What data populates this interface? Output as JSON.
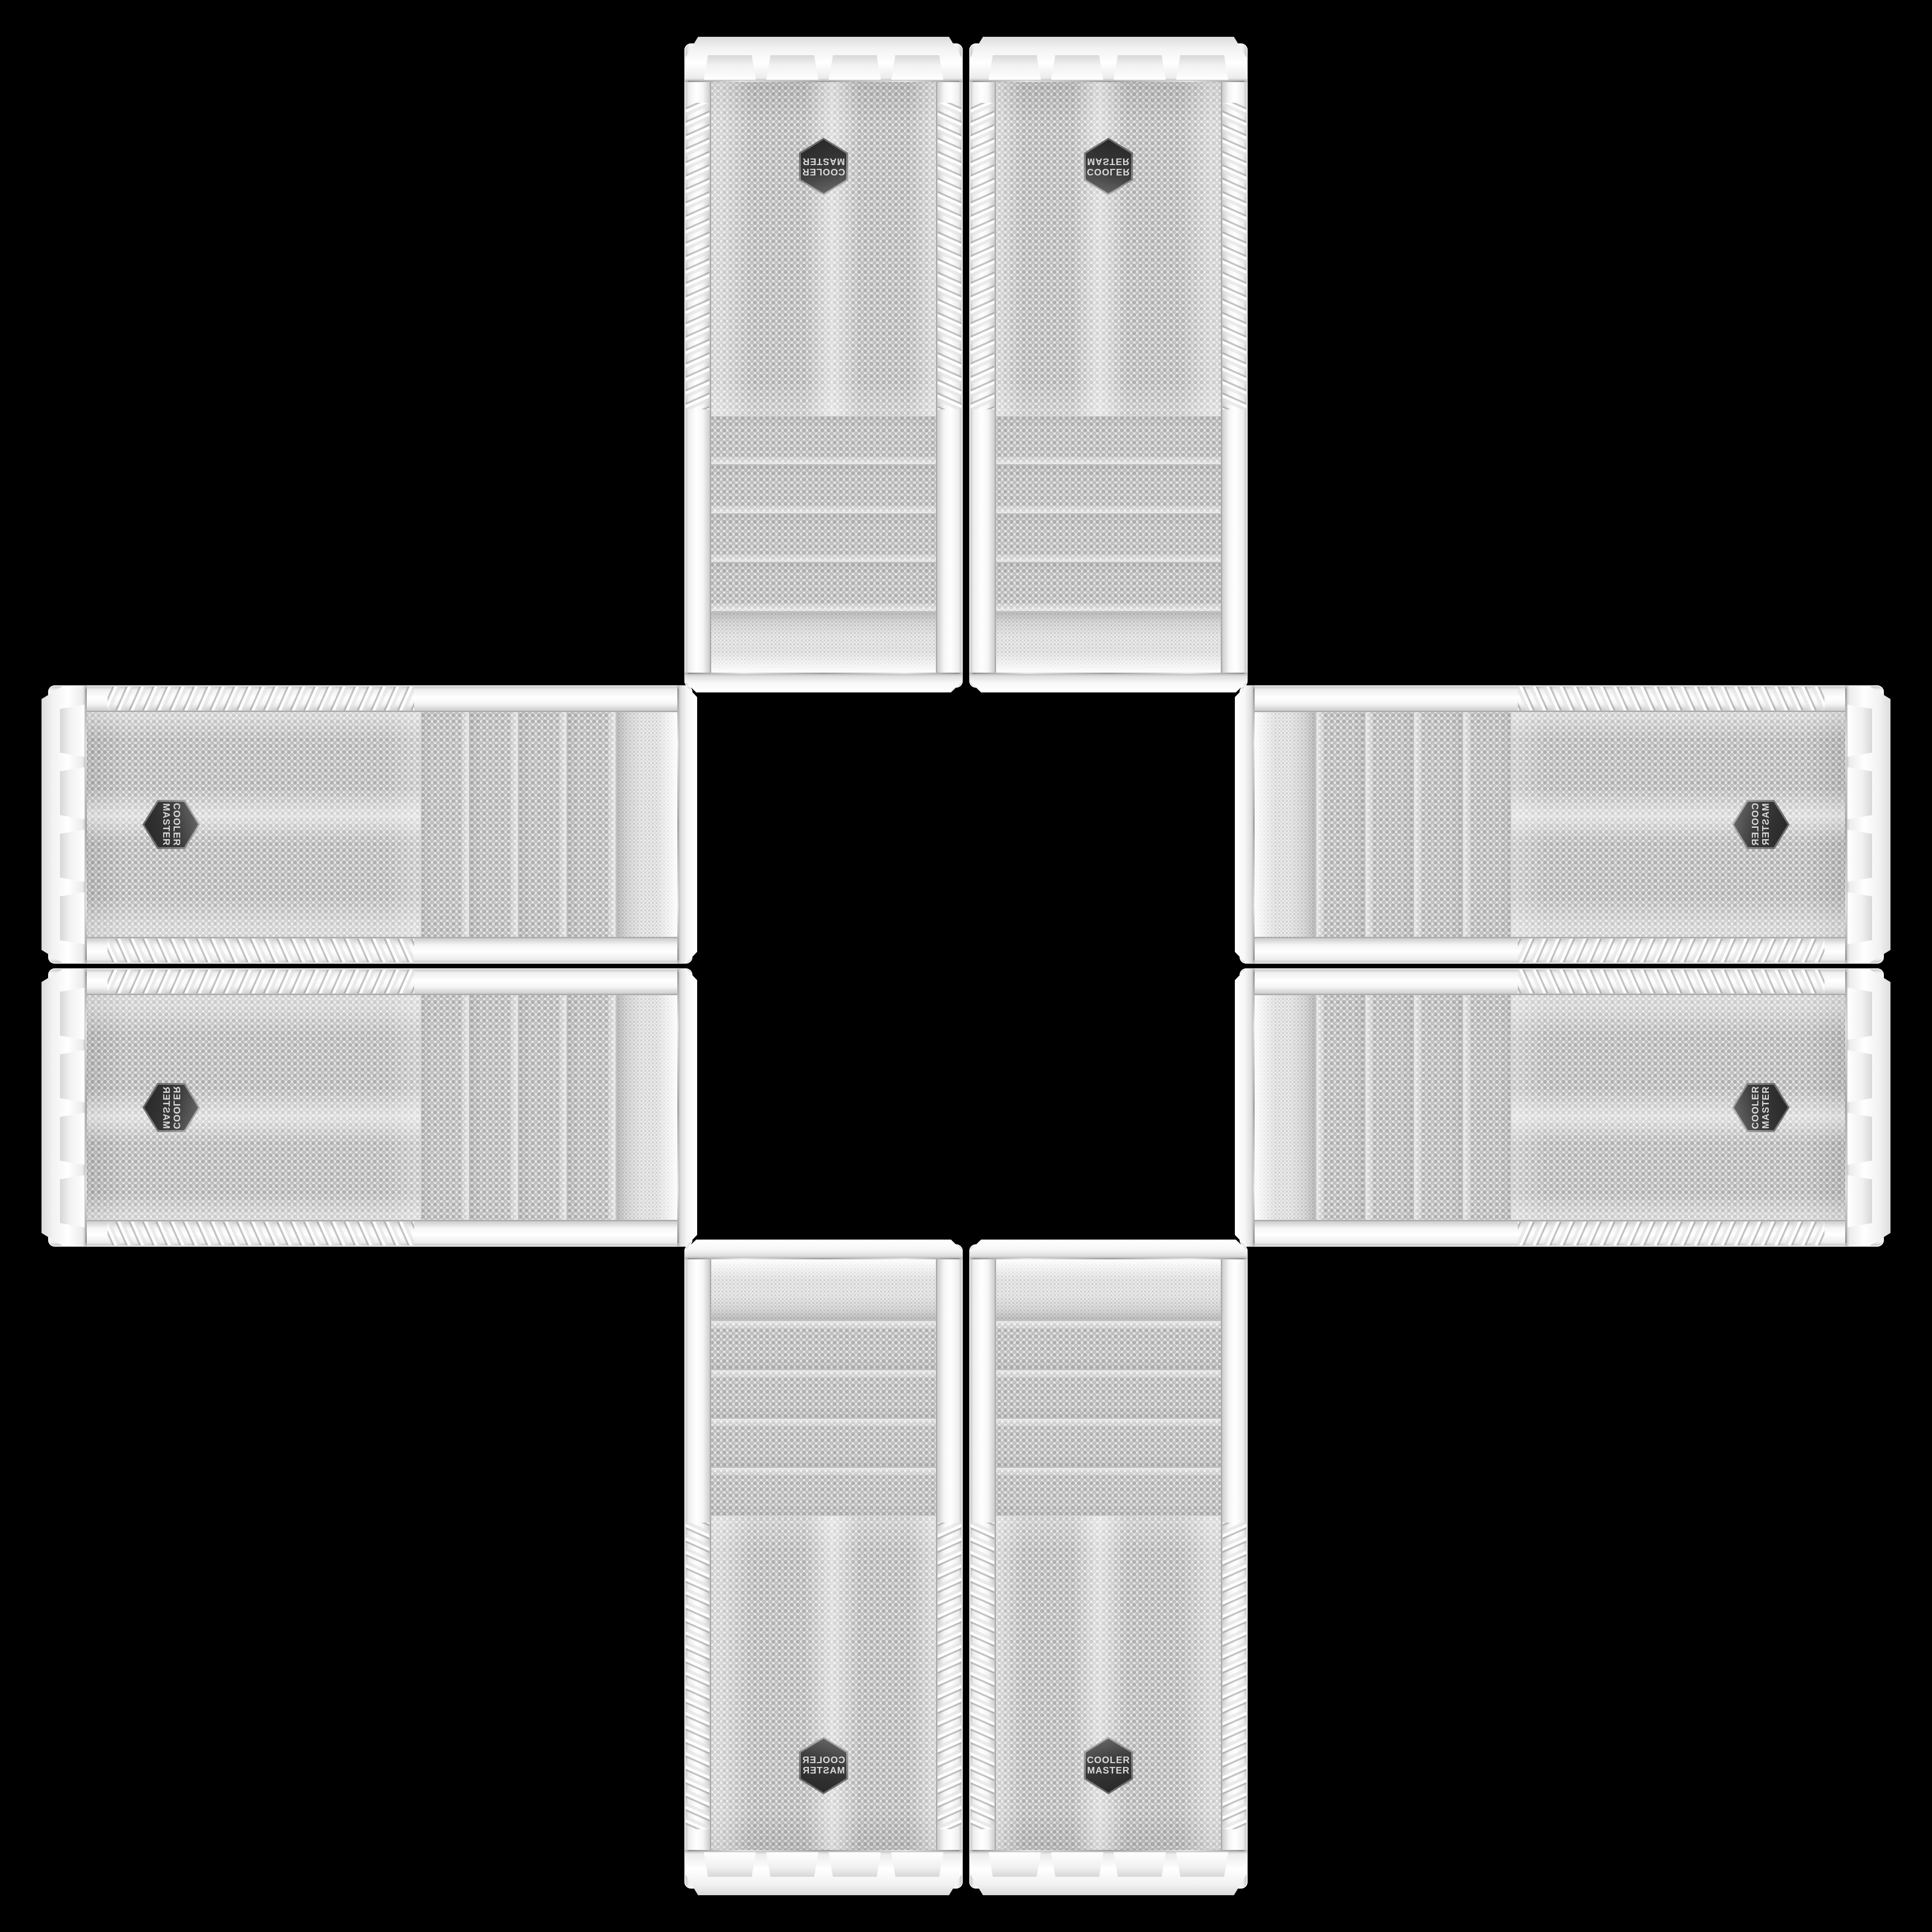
{
  "scene": {
    "background_color": "#000000",
    "panel_count": 8,
    "arrangement": "cross"
  },
  "badge": {
    "line1": "COOLER",
    "line2": "MASTER",
    "badge_color": "#3a3a3a",
    "text_color": "#d9d9d9"
  },
  "colors": {
    "panel_white": "#f4f4f4",
    "mesh_base": "#e9e9e9",
    "mesh_dot": "#b0b0b0",
    "chrome_seam": "#c2c2c2"
  }
}
